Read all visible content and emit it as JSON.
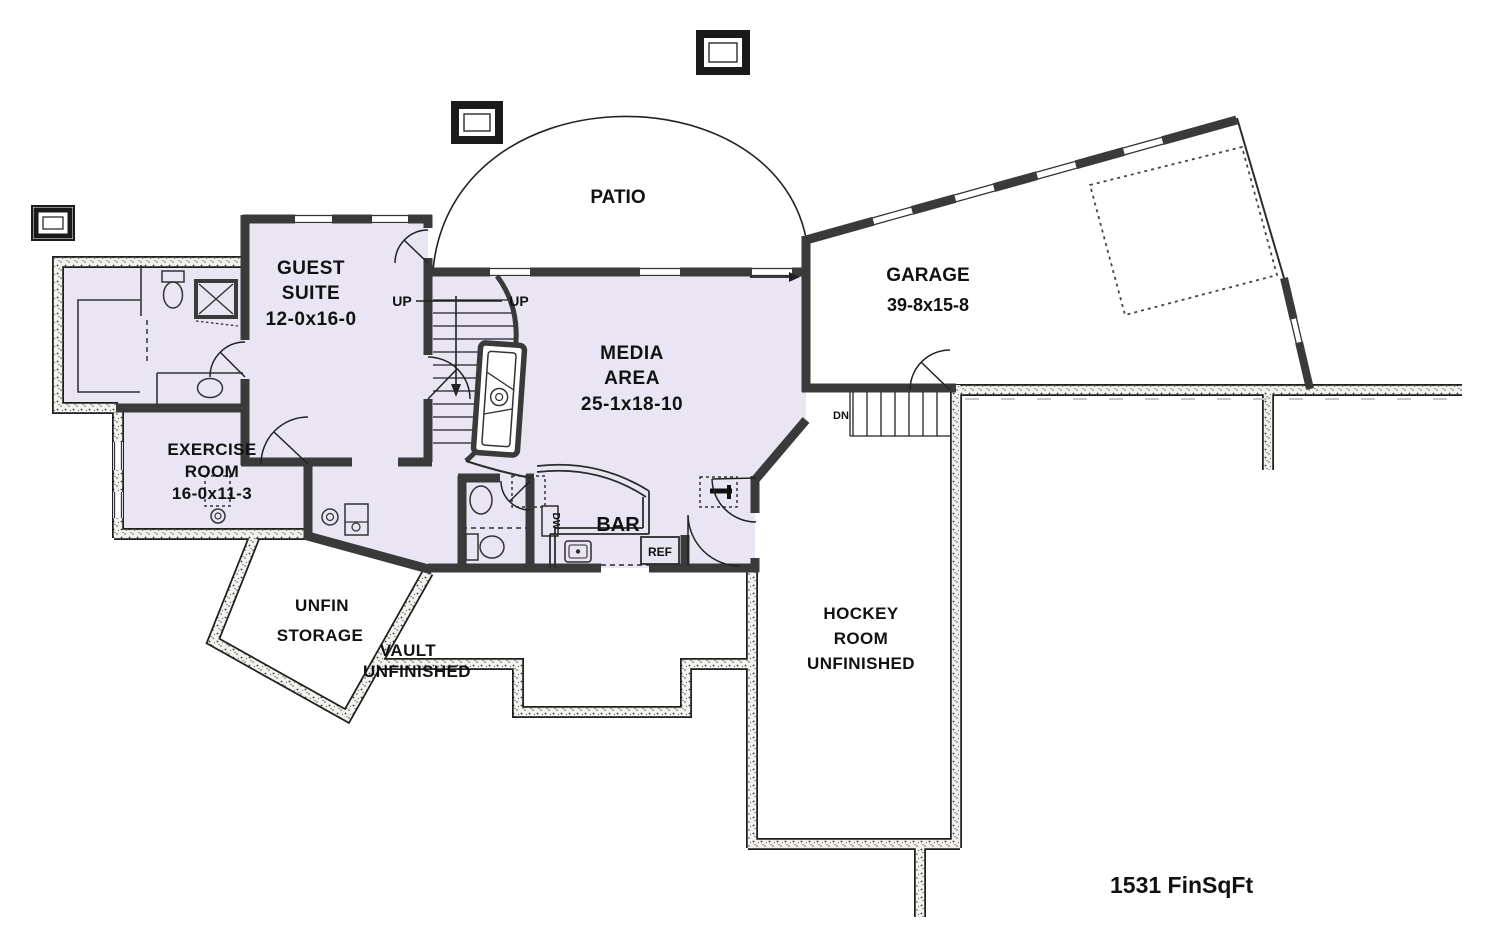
{
  "floor_plan": {
    "patio_label": "PATIO",
    "guest_suite": {
      "l1": "GUEST",
      "l2": "SUITE",
      "dims": "12-0x16-0"
    },
    "garage": {
      "l1": "GARAGE",
      "dims": "39-8x15-8"
    },
    "media_area": {
      "l1": "MEDIA",
      "l2": "AREA",
      "dims": "25-1x18-10"
    },
    "exercise_room": {
      "l1": "EXERCISE",
      "l2": "ROOM",
      "dims": "16-0x11-3"
    },
    "bar": {
      "l1": "BAR",
      "dishwasher": "DW",
      "refrigerator": "REF"
    },
    "unfin_storage": {
      "l1": "UNFIN",
      "l2": "STORAGE"
    },
    "vault": {
      "l1": "VAULT",
      "l2": "UNFINISHED"
    },
    "hockey_room": {
      "l1": "HOCKEY",
      "l2": "ROOM",
      "l3": "UNFINISHED"
    },
    "stairs": {
      "up_left": "UP",
      "up_right": "UP",
      "down": "DN"
    },
    "summary": "1531 FinSqFt",
    "colors": {
      "finished_area_fill": "#EAE5F3",
      "walls": "#3A3A3A",
      "background": "#FFFFFF"
    }
  }
}
